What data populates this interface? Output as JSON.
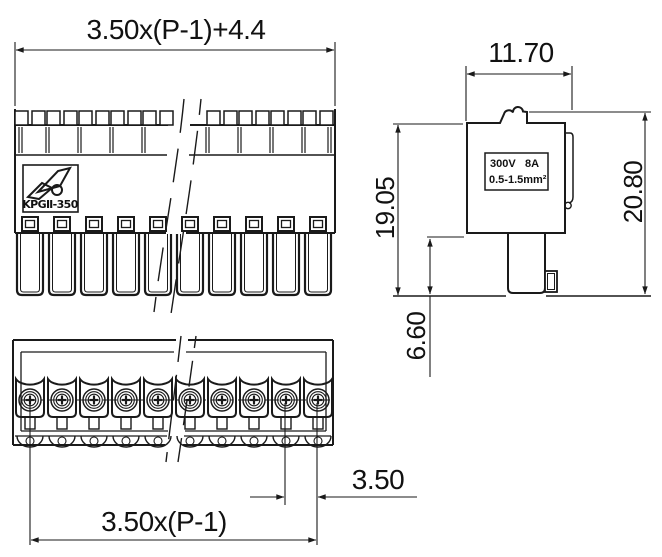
{
  "drawing_type": "terminal-block-connector-technical-drawing",
  "dimensions": {
    "top_width": "3.50x(P-1)+4.4",
    "side_width": "11.70",
    "body_height": "19.05",
    "total_height": "20.80",
    "pin_length": "6.60",
    "pitch": "3.50",
    "span": "3.50x(P-1)"
  },
  "side_label": {
    "voltage": "300V",
    "current": "8A",
    "wire_range": "0.5-1.5mm²"
  },
  "logo": {
    "model": "KPGⅡ-350"
  },
  "colors": {
    "line": "#1a1a1a",
    "background": "#ffffff"
  }
}
